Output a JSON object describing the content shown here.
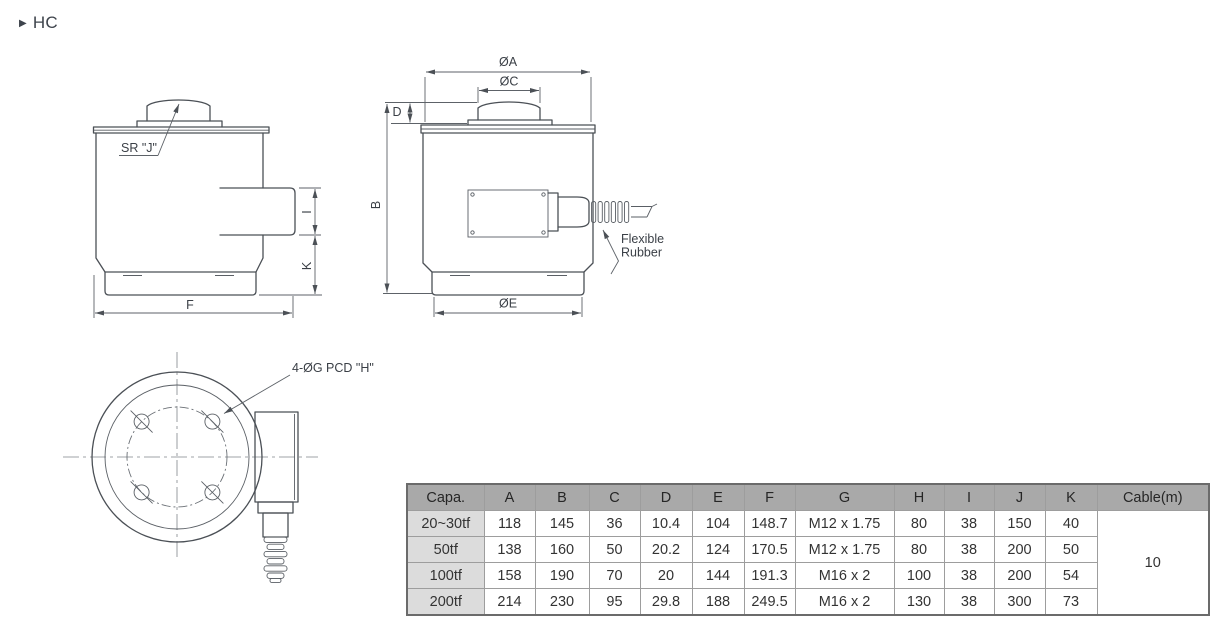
{
  "title": {
    "marker": "▶",
    "label": "HC"
  },
  "drawings": {
    "left_side_view": {
      "labels": {
        "sphere_radius": "SR \"J\"",
        "dim_f": "F",
        "dim_i": "I",
        "dim_k": "K"
      }
    },
    "front_view": {
      "labels": {
        "dia_a": "ØA",
        "dia_c": "ØC",
        "dim_d": "D",
        "dim_b": "B",
        "dia_e": "ØE",
        "flexible_rubber_line1": "Flexible",
        "flexible_rubber_line2": "Rubber"
      }
    },
    "bottom_view": {
      "labels": {
        "bolt_holes": "4-ØG PCD \"H\""
      }
    }
  },
  "table": {
    "columns": [
      "Capa.",
      "A",
      "B",
      "C",
      "D",
      "E",
      "F",
      "G",
      "H",
      "I",
      "J",
      "K",
      "Cable(m)"
    ],
    "rows": [
      {
        "capacity": "20~30tf",
        "values": [
          "118",
          "145",
          "36",
          "10.4",
          "104",
          "148.7",
          "M12 x 1.75",
          "80",
          "38",
          "150",
          "40"
        ]
      },
      {
        "capacity": "50tf",
        "values": [
          "138",
          "160",
          "50",
          "20.2",
          "124",
          "170.5",
          "M12 x 1.75",
          "80",
          "38",
          "200",
          "50"
        ]
      },
      {
        "capacity": "100tf",
        "values": [
          "158",
          "190",
          "70",
          "20",
          "144",
          "191.3",
          "M16 x 2",
          "100",
          "38",
          "200",
          "54"
        ]
      },
      {
        "capacity": "200tf",
        "values": [
          "214",
          "230",
          "95",
          "29.8",
          "188",
          "249.5",
          "M16 x 2",
          "130",
          "38",
          "300",
          "73"
        ]
      }
    ],
    "cable_length": "10"
  },
  "colors": {
    "line": "#4b5056",
    "header_bg": "#a9a9a9",
    "first_col_bg": "#dcdcdc",
    "text": "#333333"
  }
}
